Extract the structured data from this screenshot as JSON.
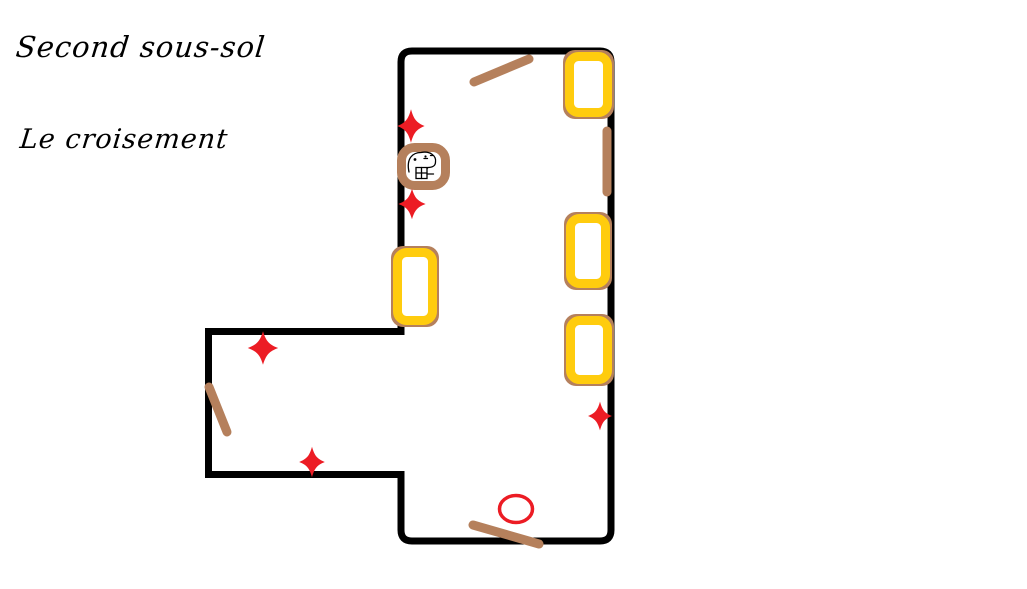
{
  "titles": {
    "floor": "Second sous-sol",
    "room": "Le croisement"
  },
  "colors": {
    "background": "#FFFFFF",
    "wall": "#000000",
    "marker_yellow": "#FFCC0E",
    "marker_brown": "#B5805C",
    "marker_red": "#EC1C24",
    "ink": "#000000"
  },
  "map": {
    "wall_width": 7,
    "outline_path": "M 412 51 L 600 51 Q 611 51 611 62 L 611 530 Q 611 541 600 541 L 412 541 Q 401 541 401 530 L 401 474.5 L 208.5 474.5 L 208.5 331.5 L 401 331.5 L 401 62 Q 401 51 412 51 Z",
    "yellow_markers": [
      {
        "name": "yellow-marker-top",
        "x": 565,
        "y": 52,
        "w": 47,
        "h": 65
      },
      {
        "name": "yellow-marker-right-mid",
        "x": 566,
        "y": 214,
        "w": 44,
        "h": 74
      },
      {
        "name": "yellow-marker-right-low",
        "x": 566,
        "y": 316,
        "w": 46,
        "h": 68
      },
      {
        "name": "yellow-marker-left",
        "x": 393,
        "y": 248,
        "w": 44,
        "h": 77
      }
    ],
    "yellow_stroke": 9,
    "yellow_radius": 9,
    "sticks": [
      {
        "name": "stick-top",
        "x1": 474,
        "y1": 82,
        "x2": 529,
        "y2": 59
      },
      {
        "name": "stick-right-wall",
        "x1": 607,
        "y1": 131,
        "x2": 607,
        "y2": 192
      },
      {
        "name": "stick-annex",
        "x1": 209,
        "y1": 387,
        "x2": 227,
        "y2": 432
      },
      {
        "name": "stick-bottom",
        "x1": 473,
        "y1": 525,
        "x2": 539,
        "y2": 544
      }
    ],
    "stick_width": 9,
    "sparkle_path": "M0,-16 C3.2,-6.5 6.5,-3.2 16,0 C6.5,3.2 3.2,6.5 0,16 C-3.2,6.5 -6.5,3.2 -16,0 C-6.5,-3.2 -3.2,-6.5 0,-16 Z",
    "sparkles": [
      {
        "name": "sparkle-left-wall-upper",
        "cx": 411,
        "cy": 126,
        "sx": 0.85,
        "sy": 1.05
      },
      {
        "name": "sparkle-left-wall-lower",
        "cx": 412,
        "cy": 204,
        "sx": 0.85,
        "sy": 0.95
      },
      {
        "name": "sparkle-annex-top",
        "cx": 263,
        "cy": 348,
        "sx": 0.95,
        "sy": 1.05
      },
      {
        "name": "sparkle-annex-bottom",
        "cx": 312,
        "cy": 462,
        "sx": 0.8,
        "sy": 0.95
      },
      {
        "name": "sparkle-right-wall",
        "cx": 600,
        "cy": 416,
        "sx": 0.75,
        "sy": 0.9
      }
    ],
    "circle_mark": {
      "cx": 516,
      "cy": 509,
      "rx": 16.5,
      "ry": 13.5,
      "stroke_width": 3.5
    },
    "creature": {
      "x": 397,
      "y": 143,
      "w": 53,
      "h": 47,
      "stroke": 9,
      "radius": 13,
      "face_paths": [
        "M12,29 C9,15 16,9.5 24,9.5 C33,7.5 39.5,13 38.5,19 C38.5,23 35,24.5 31,24.5 L30,25.5",
        "M19,24.5 h11 v11 h-11 z",
        "M19,30 h11",
        "M24.5,24.5 v11",
        "M30,31 h6.5",
        "M27,15.5 h3.5",
        "M33.5,12.5 h2"
      ],
      "eye_dots": [
        {
          "cx": 18,
          "cy": 16.5,
          "r": 1.4
        },
        {
          "cx": 28.5,
          "cy": 13.5,
          "r": 1.1
        }
      ]
    }
  }
}
